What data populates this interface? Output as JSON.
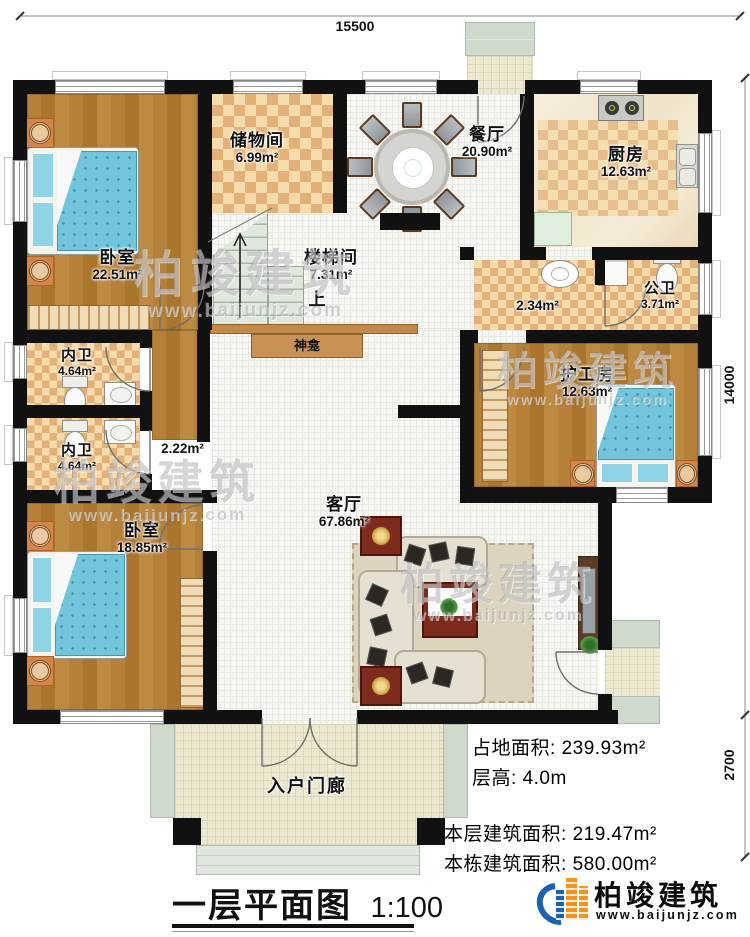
{
  "title": {
    "text": "一层平面图",
    "scale": "1:100"
  },
  "dimensions": {
    "top_width": "15500",
    "right_height": "14000",
    "right_porch": "2700"
  },
  "rooms": [
    {
      "id": "bedroom-tl",
      "name": "卧室",
      "area": "22.51m²"
    },
    {
      "id": "storage",
      "name": "储物间",
      "area": "6.99m²"
    },
    {
      "id": "dining",
      "name": "餐厅",
      "area": "20.90m²"
    },
    {
      "id": "kitchen",
      "name": "厨房",
      "area": "12.63m²"
    },
    {
      "id": "stairwell",
      "name": "楼梯间",
      "area": "7.31m²"
    },
    {
      "id": "wash-area",
      "name": "",
      "area": "2.34m²"
    },
    {
      "id": "public-bath",
      "name": "公卫",
      "area": "3.71m²"
    },
    {
      "id": "bath-upper",
      "name": "内卫",
      "area": "4.64m²"
    },
    {
      "id": "hallway",
      "name": "",
      "area": "2.22m²"
    },
    {
      "id": "bath-lower",
      "name": "内卫",
      "area": "4.64m²"
    },
    {
      "id": "caregiver-room",
      "name": "护工房",
      "area": "12.63m²"
    },
    {
      "id": "living-room",
      "name": "客厅",
      "area": "67.86m²"
    },
    {
      "id": "bedroom-bl",
      "name": "卧室",
      "area": "18.85m²"
    },
    {
      "id": "entry-porch",
      "name": "入户门廊",
      "area": ""
    }
  ],
  "labels": {
    "stairs_up": "上",
    "shrine": "神龛"
  },
  "stats": [
    {
      "label": "占地面积:",
      "value": "239.93m²"
    },
    {
      "label": "层高:",
      "value": "4.0m"
    },
    {
      "label": "本层建筑面积:",
      "value": "219.47m²"
    },
    {
      "label": "本栋建筑面积:",
      "value": "580.00m²"
    }
  ],
  "branding": {
    "name": "柏竣建筑",
    "url": "www.baijunjz.com"
  },
  "watermark": {
    "name": "柏竣建筑",
    "url": "www.baijunjz.com"
  },
  "colors": {
    "wall": "#111111",
    "wood": "#b5813a",
    "checker": "#e3b077",
    "bed_blue": "#72c5da",
    "brand_blue": "#1b62ab",
    "brand_orange": "#f7941d"
  }
}
